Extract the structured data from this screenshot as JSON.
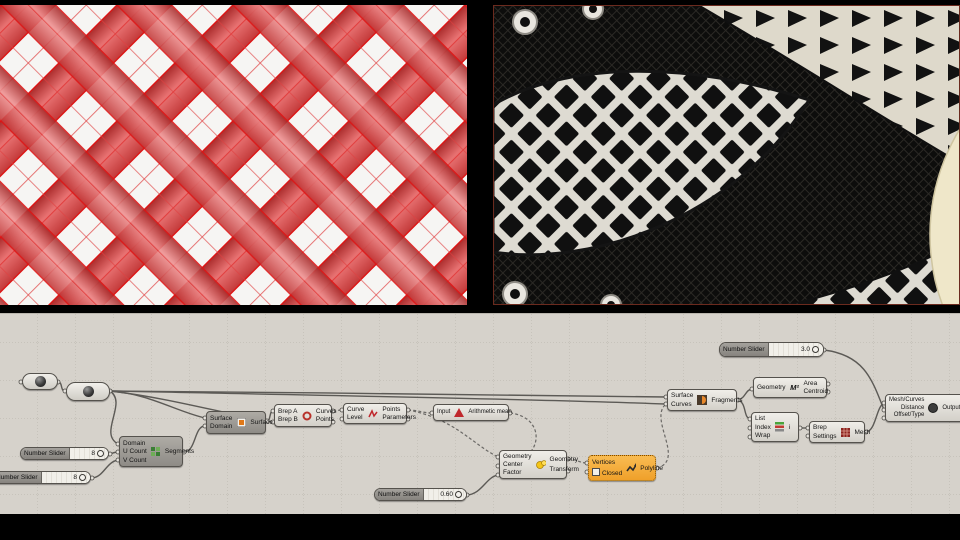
{
  "viewport": {
    "left_render": "red-diagrid-lattice-render",
    "right_photo": "sneaker-lattice-fabric-photo"
  },
  "colors": {
    "canvas_bg": "#d6d2cb",
    "lattice_red": "#d23b2f",
    "warn_orange": "#f2a42e",
    "cream_circle": "#efe7c9",
    "wire_grey": "#5c5a56"
  },
  "gh": {
    "sliders": {
      "u": {
        "label": "Number Slider",
        "value": "8"
      },
      "v": {
        "label": "Number Slider",
        "value": "8"
      },
      "factor": {
        "label": "Number Slider",
        "value": "0.60"
      },
      "distance": {
        "label": "Number Slider",
        "value": "3.0"
      }
    },
    "divide": {
      "inputs": [
        "Domain",
        "U Count",
        "V Count"
      ],
      "output": "Segments"
    },
    "isotrim": {
      "inputs": [
        "Surface",
        "Domain"
      ],
      "output": "Surface"
    },
    "bbx": {
      "inputs": [
        "Brep A",
        "Brep B"
      ],
      "outputs": [
        "Curves",
        "Points"
      ]
    },
    "discontinuity": {
      "inputs": [
        "Curve",
        "Level"
      ],
      "outputs": [
        "Points",
        "Parameters"
      ]
    },
    "average": {
      "input": "Input",
      "output": "Arithmetic mean"
    },
    "scale": {
      "inputs": [
        "Geometry",
        "Center",
        "Factor"
      ],
      "outputs": [
        "Geometry",
        "Transform"
      ]
    },
    "polyline": {
      "inputs": [
        "Vertices",
        "Closed"
      ],
      "output": "Polyline"
    },
    "srfsplit": {
      "inputs": [
        "Surface",
        "Curves"
      ],
      "output": "Fragments"
    },
    "area": {
      "input": "Geometry",
      "outputs": [
        "Area",
        "Centroid"
      ],
      "icon_text": "M²"
    },
    "listitem": {
      "inputs": [
        "List",
        "Index",
        "Wrap"
      ],
      "output": "i"
    },
    "meshbrep": {
      "inputs": [
        "Brep",
        "Settings"
      ],
      "output": "Mesh"
    },
    "offsetmesh": {
      "inputs": [
        "Mesh/Curves",
        "Distance",
        "Offset/Type"
      ],
      "output": "Output Mesh/"
    }
  }
}
